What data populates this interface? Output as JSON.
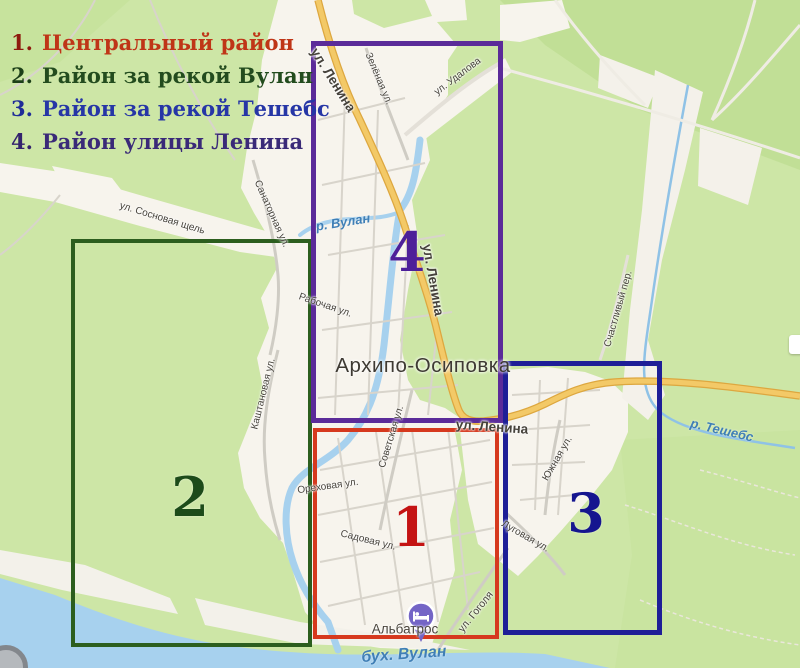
{
  "legend": {
    "items": [
      {
        "num": "1.",
        "label": "Центральный район",
        "num_color": "#8e1a0e",
        "label_color": "#bf3517"
      },
      {
        "num": "2.",
        "label": "Район за рекой Вулан",
        "num_color": "#1c3f18",
        "label_color": "#234c1e"
      },
      {
        "num": "3.",
        "label": "Район за рекой Тешебс",
        "num_color": "#1f2c98",
        "label_color": "#2636a6"
      },
      {
        "num": "4.",
        "label": "Район улицы Ленина",
        "num_color": "#33236d",
        "label_color": "#3a2a78"
      }
    ]
  },
  "districts": [
    {
      "number": "1",
      "name": "Центральный район",
      "box_color": "#d6391e",
      "number_color": "#c41313"
    },
    {
      "number": "2",
      "name": "Район за рекой Вулан",
      "box_color": "#2c5e1e",
      "number_color": "#1d4b1a"
    },
    {
      "number": "3",
      "name": "Район за рекой Тешебс",
      "box_color": "#1e1e97",
      "number_color": "#15158f"
    },
    {
      "number": "4",
      "name": "Район улицы Ленина",
      "box_color": "#5b2b99",
      "number_color": "#4d1f99"
    }
  ],
  "map": {
    "town_name": "Архипо-Осиповка",
    "poi": {
      "name": "Альбатрос",
      "pin_color": "#7465c6",
      "icon": "lodging-bed-icon"
    },
    "streets": [
      {
        "text": "ул. Ленина"
      },
      {
        "text": "Зелёная ул."
      },
      {
        "text": "ул. Удалова"
      },
      {
        "text": "ул. Сосновая щель"
      },
      {
        "text": "Санаторная ул."
      },
      {
        "text": "Рабочая ул."
      },
      {
        "text": "ул. Ленина"
      },
      {
        "text": "Каштановая ул."
      },
      {
        "text": "ул. Ленина"
      },
      {
        "text": "Советская ул."
      },
      {
        "text": "Ореховая ул."
      },
      {
        "text": "Садовая ул."
      },
      {
        "text": "ул. Гоголя"
      },
      {
        "text": "Южная ул."
      },
      {
        "text": "Луговая ул."
      },
      {
        "text": "Счастливый пер."
      }
    ],
    "water_labels": [
      {
        "text": "р. Вулан"
      },
      {
        "text": "р. Тешебс"
      },
      {
        "text": "бух. Вулан"
      }
    ],
    "colors": {
      "land": "#cde6a6",
      "forest": "#bedd92",
      "urban": "#f7f4ed",
      "water": "#a7d1ee",
      "main_road_fill": "#f3c967",
      "main_road_casing": "#dda73f",
      "minor_road": "#d8d4cb"
    }
  }
}
